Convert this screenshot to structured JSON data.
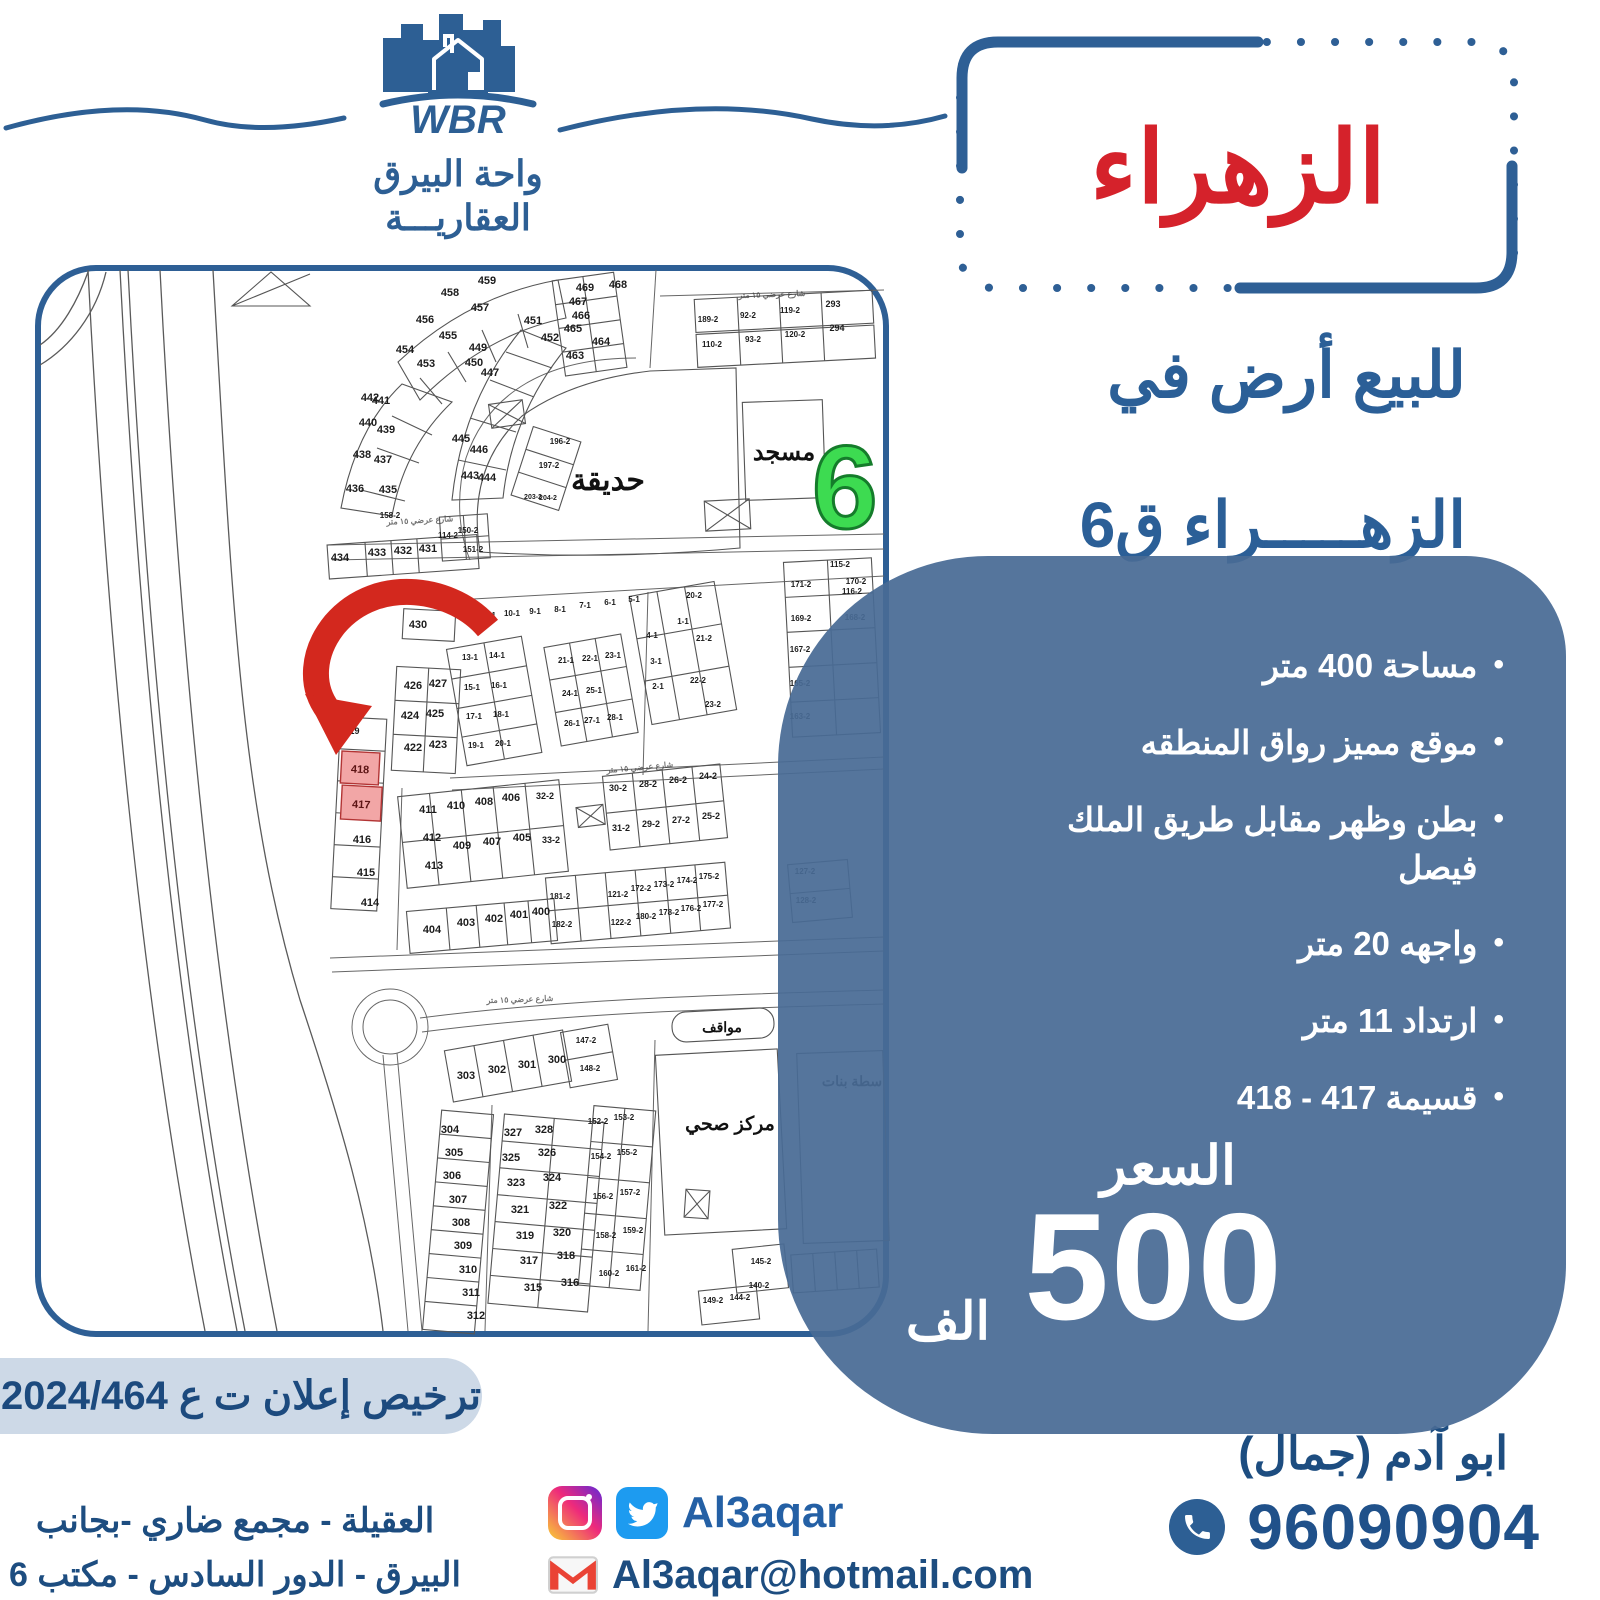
{
  "brand": {
    "acronym": "WBR",
    "name_line1": "واحة البيرق",
    "name_line2": "العقاريـــة"
  },
  "title": "الزهراء",
  "subtitle": {
    "line1": "للبيع أرض في",
    "line2": "الزهـــــراء ق6"
  },
  "features": [
    "مساحة 400 متر",
    "موقع مميز رواق المنطقه",
    "بطن وظهر مقابل طريق الملك فيصل",
    "واجهه 20 متر",
    "ارتداد 11 متر",
    "قسيمة 417 - 418"
  ],
  "price": {
    "label": "السعر",
    "amount": "500",
    "unit": "الف"
  },
  "license": "ترخيص إعلان ت ع 2024/464",
  "address": {
    "line1": "العقيلة - مجمع ضاري -بجانب",
    "line2": "البيرق - الدور السادس - مكتب 6"
  },
  "social": {
    "handle": "Al3aqar",
    "email": "Al3aqar@hotmail.com"
  },
  "contact": {
    "name": "ابو آدم (جمال)",
    "phone": "96090904"
  },
  "colors": {
    "accent_blue": "#2b5f97",
    "panel_blue": "#48698f",
    "title_red": "#d5222b",
    "district_green": "#3ddb51",
    "highlight_pink": "#f2a6a6",
    "pill_gray": "#cdd9e7"
  },
  "map": {
    "district_number": "6",
    "labels": {
      "garden": "حديقة",
      "mosque": "مسجد",
      "parking": "مواقف",
      "health_center": "مركز صحي",
      "girls_school": "سطة بنات"
    },
    "street_label": "شارع عرضي ١٥ متر",
    "street_label_positions": [
      {
        "x": 420,
        "y": 523,
        "r": -3
      },
      {
        "x": 640,
        "y": 770,
        "r": -5
      },
      {
        "x": 520,
        "y": 1002,
        "r": -2
      },
      {
        "x": 772,
        "y": 297,
        "r": -2
      }
    ],
    "highlighted_plots": [
      "418",
      "417"
    ],
    "plots": [
      [
        "189-2",
        708,
        322,
        8
      ],
      [
        "92-2",
        748,
        318,
        8
      ],
      [
        "119-2",
        790,
        313,
        8
      ],
      [
        "293",
        833,
        307,
        9
      ],
      [
        "110-2",
        712,
        347,
        8
      ],
      [
        "93-2",
        753,
        342,
        8
      ],
      [
        "120-2",
        795,
        337,
        8
      ],
      [
        "294",
        837,
        331,
        9
      ],
      [
        "469",
        585,
        291
      ],
      [
        "468",
        618,
        288
      ],
      [
        "467",
        578,
        305
      ],
      [
        "466",
        581,
        319
      ],
      [
        "465",
        573,
        332
      ],
      [
        "464",
        601,
        345
      ],
      [
        "463",
        575,
        359
      ],
      [
        "459",
        487,
        284
      ],
      [
        "458",
        450,
        296
      ],
      [
        "457",
        480,
        311
      ],
      [
        "456",
        425,
        323
      ],
      [
        "455",
        448,
        339
      ],
      [
        "454",
        405,
        353
      ],
      [
        "453",
        426,
        367
      ],
      [
        "452",
        550,
        341
      ],
      [
        "451",
        533,
        324
      ],
      [
        "449",
        478,
        351
      ],
      [
        "450",
        474,
        366
      ],
      [
        "447",
        490,
        376
      ],
      [
        "445",
        461,
        442
      ],
      [
        "446",
        479,
        453
      ],
      [
        "443",
        470,
        479
      ],
      [
        "444",
        487,
        481
      ],
      [
        "442",
        370,
        401
      ],
      [
        "441",
        381,
        404
      ],
      [
        "440",
        368,
        426
      ],
      [
        "439",
        386,
        433
      ],
      [
        "438",
        362,
        458
      ],
      [
        "437",
        383,
        463
      ],
      [
        "436",
        355,
        492
      ],
      [
        "435",
        388,
        493
      ],
      [
        "196-2",
        560,
        444,
        8
      ],
      [
        "197-2",
        549,
        468,
        8
      ],
      [
        "203-2",
        533,
        499,
        7
      ],
      [
        "204-2",
        548,
        500,
        7
      ],
      [
        "158-2",
        390,
        518,
        8
      ],
      [
        "114-2",
        448,
        538,
        8
      ],
      [
        "150-2",
        468,
        533,
        8
      ],
      [
        "151-2",
        473,
        552,
        8
      ],
      [
        "434",
        340,
        561
      ],
      [
        "433",
        377,
        556
      ],
      [
        "432",
        403,
        554
      ],
      [
        "431",
        428,
        552
      ],
      [
        "12-1",
        488,
        618,
        8
      ],
      [
        "10-1",
        512,
        616,
        8
      ],
      [
        "9-1",
        535,
        614,
        8
      ],
      [
        "8-1",
        560,
        612,
        8
      ],
      [
        "7-1",
        585,
        608,
        8
      ],
      [
        "6-1",
        610,
        605,
        8
      ],
      [
        "5-1",
        634,
        602,
        8
      ],
      [
        "13-1",
        470,
        660,
        8
      ],
      [
        "14-1",
        497,
        658,
        8
      ],
      [
        "15-1",
        472,
        690,
        8
      ],
      [
        "16-1",
        499,
        688,
        8
      ],
      [
        "17-1",
        474,
        719,
        8
      ],
      [
        "18-1",
        501,
        717,
        8
      ],
      [
        "19-1",
        476,
        748,
        8
      ],
      [
        "20-1",
        503,
        746,
        8
      ],
      [
        "21-1",
        566,
        663,
        8
      ],
      [
        "22-1",
        590,
        661,
        8
      ],
      [
        "23-1",
        613,
        658,
        8
      ],
      [
        "24-1",
        570,
        696,
        8
      ],
      [
        "25-1",
        594,
        693,
        8
      ],
      [
        "26-1",
        572,
        726,
        8
      ],
      [
        "27-1",
        592,
        723,
        8
      ],
      [
        "28-1",
        615,
        720,
        8
      ],
      [
        "1-1",
        683,
        624,
        8
      ],
      [
        "4-1",
        652,
        638,
        8
      ],
      [
        "3-1",
        656,
        664,
        8
      ],
      [
        "2-1",
        658,
        689,
        8
      ],
      [
        "20-2",
        694,
        598,
        8
      ],
      [
        "21-2",
        704,
        641,
        8
      ],
      [
        "22-2",
        698,
        683,
        8
      ],
      [
        "23-2",
        713,
        707,
        8
      ],
      [
        "115-2",
        840,
        567,
        8
      ],
      [
        "116-2",
        852,
        594,
        8
      ],
      [
        "171-2",
        801,
        587,
        8
      ],
      [
        "170-2",
        856,
        584,
        8
      ],
      [
        "169-2",
        801,
        621,
        8
      ],
      [
        "168-2",
        855,
        620,
        8
      ],
      [
        "167-2",
        800,
        652,
        8
      ],
      [
        "165-2",
        800,
        686,
        8
      ],
      [
        "163-2",
        800,
        719,
        8
      ],
      [
        "419",
        352,
        734,
        9
      ],
      [
        "416",
        362,
        843
      ],
      [
        "415",
        366,
        876
      ],
      [
        "414",
        370,
        906
      ],
      [
        "430",
        418,
        628
      ],
      [
        "426",
        413,
        689
      ],
      [
        "427",
        438,
        687
      ],
      [
        "424",
        410,
        719
      ],
      [
        "425",
        435,
        717
      ],
      [
        "422",
        413,
        751
      ],
      [
        "423",
        438,
        748
      ],
      [
        "411",
        428,
        813
      ],
      [
        "410",
        456,
        809
      ],
      [
        "408",
        484,
        805
      ],
      [
        "406",
        511,
        801
      ],
      [
        "412",
        432,
        841
      ],
      [
        "409",
        462,
        849
      ],
      [
        "407",
        492,
        845
      ],
      [
        "405",
        522,
        841
      ],
      [
        "413",
        434,
        869
      ],
      [
        "32-2",
        545,
        799,
        9
      ],
      [
        "33-2",
        551,
        843,
        9
      ],
      [
        "30-2",
        618,
        791,
        9
      ],
      [
        "28-2",
        648,
        787,
        9
      ],
      [
        "26-2",
        678,
        783,
        9
      ],
      [
        "24-2",
        708,
        779,
        9
      ],
      [
        "31-2",
        621,
        831,
        9
      ],
      [
        "29-2",
        651,
        827,
        9
      ],
      [
        "27-2",
        681,
        823,
        9
      ],
      [
        "25-2",
        711,
        819,
        9
      ],
      [
        "404",
        432,
        933
      ],
      [
        "403",
        466,
        926
      ],
      [
        "402",
        494,
        922
      ],
      [
        "401",
        519,
        918
      ],
      [
        "400",
        541,
        915
      ],
      [
        "181-2",
        560,
        899,
        8
      ],
      [
        "182-2",
        562,
        927,
        8
      ],
      [
        "121-2",
        618,
        897,
        8
      ],
      [
        "122-2",
        621,
        925,
        8
      ],
      [
        "172-2",
        641,
        891,
        8
      ],
      [
        "180-2",
        646,
        919,
        8
      ],
      [
        "173-2",
        664,
        887,
        8
      ],
      [
        "178-2",
        669,
        915,
        8
      ],
      [
        "174-2",
        687,
        883,
        8
      ],
      [
        "176-2",
        691,
        911,
        8
      ],
      [
        "175-2",
        709,
        879,
        8
      ],
      [
        "177-2",
        713,
        907,
        8
      ],
      [
        "127-2",
        805,
        874,
        8
      ],
      [
        "128-2",
        806,
        903,
        8
      ],
      [
        "303",
        466,
        1079
      ],
      [
        "302",
        497,
        1073
      ],
      [
        "301",
        527,
        1068
      ],
      [
        "300",
        557,
        1063
      ],
      [
        "147-2",
        586,
        1043,
        8
      ],
      [
        "148-2",
        590,
        1071,
        8
      ],
      [
        "304",
        450,
        1133
      ],
      [
        "305",
        454,
        1156
      ],
      [
        "306",
        452,
        1179
      ],
      [
        "307",
        458,
        1203
      ],
      [
        "308",
        461,
        1226
      ],
      [
        "309",
        463,
        1249
      ],
      [
        "310",
        468,
        1273
      ],
      [
        "311",
        471,
        1296
      ],
      [
        "312",
        476,
        1319
      ],
      [
        "327",
        513,
        1136
      ],
      [
        "328",
        544,
        1133
      ],
      [
        "325",
        511,
        1161
      ],
      [
        "326",
        547,
        1156
      ],
      [
        "323",
        516,
        1186
      ],
      [
        "324",
        552,
        1181
      ],
      [
        "321",
        520,
        1213
      ],
      [
        "322",
        558,
        1209
      ],
      [
        "319",
        525,
        1239
      ],
      [
        "320",
        562,
        1236
      ],
      [
        "317",
        529,
        1264
      ],
      [
        "318",
        566,
        1259
      ],
      [
        "315",
        533,
        1291
      ],
      [
        "316",
        570,
        1286
      ],
      [
        "152-2",
        598,
        1124,
        8
      ],
      [
        "153-2",
        624,
        1120,
        8
      ],
      [
        "154-2",
        601,
        1159,
        8
      ],
      [
        "155-2",
        627,
        1155,
        8
      ],
      [
        "156-2",
        603,
        1199,
        8
      ],
      [
        "157-2",
        630,
        1195,
        8
      ],
      [
        "158-2",
        606,
        1238,
        8
      ],
      [
        "159-2",
        633,
        1233,
        8
      ],
      [
        "160-2",
        609,
        1276,
        8
      ],
      [
        "161-2",
        636,
        1271,
        8
      ],
      [
        "145-2",
        761,
        1264,
        8
      ],
      [
        "140-2",
        759,
        1288,
        8
      ],
      [
        "149-2",
        713,
        1303,
        8
      ],
      [
        "144-2",
        740,
        1300,
        8
      ]
    ]
  }
}
